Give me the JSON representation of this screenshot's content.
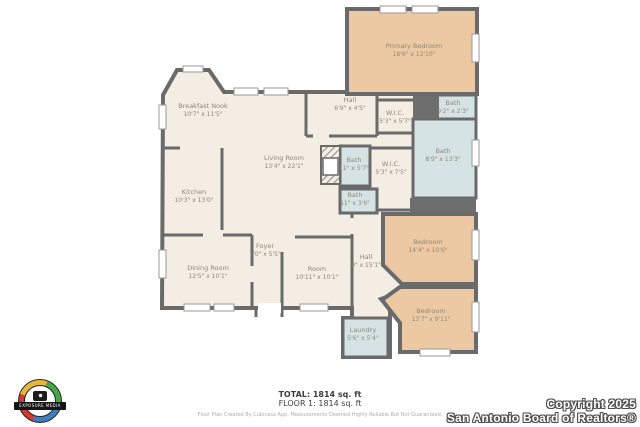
{
  "plan": {
    "rooms": [
      {
        "id": "primary-bedroom",
        "name": "Primary Bedroom",
        "dims": "18'6\" x 12'10\""
      },
      {
        "id": "breakfast-nook",
        "name": "Breakfast Nook",
        "dims": "10'7\" x 11'5\""
      },
      {
        "id": "living-room",
        "name": "Living Room",
        "dims": "13'4\" x 22'1\""
      },
      {
        "id": "kitchen",
        "name": "Kitchen",
        "dims": "10'3\" x 13'0\""
      },
      {
        "id": "dining-room",
        "name": "Dining Room",
        "dims": "12'5\" x 10'1\""
      },
      {
        "id": "foyer",
        "name": "Foyer",
        "dims": "7'0\" x 5'5\""
      },
      {
        "id": "room",
        "name": "Room",
        "dims": "10'11\" x 10'1\""
      },
      {
        "id": "hall-upper",
        "name": "Hall",
        "dims": "6'9\" x 4'5\""
      },
      {
        "id": "wic-upper",
        "name": "W.I.C.",
        "dims": "5'3\" x 5'7\""
      },
      {
        "id": "bath-niche",
        "name": "Bath",
        "dims": "9'2\" x 2'3\""
      },
      {
        "id": "bath-primary",
        "name": "Bath",
        "dims": "8'9\" x 13'3\""
      },
      {
        "id": "bath-hall",
        "name": "Bath",
        "dims": "11\" x 5'7\""
      },
      {
        "id": "wic-lower",
        "name": "W.I.C.",
        "dims": "5'3\" x 7'5\""
      },
      {
        "id": "bath-lower",
        "name": "Bath",
        "dims": "11\" x 3'6\""
      },
      {
        "id": "hall-lower",
        "name": "Hall",
        "dims": "9\" x 15'1\""
      },
      {
        "id": "bedroom-right",
        "name": "Bedroom",
        "dims": "14'4\" x 10'6\""
      },
      {
        "id": "bedroom-bottom",
        "name": "Bedroom",
        "dims": "13'7\" x 9'11\""
      },
      {
        "id": "laundry",
        "name": "Laundry",
        "dims": "5'6\" x 5'4\""
      }
    ],
    "colors": {
      "floor": "#f3ede3",
      "bedroom": "#ecc9a3",
      "wet_room": "#d5e3e4",
      "wall": "#6a6a6a"
    }
  },
  "footer": {
    "total": "TOTAL: 1814 sq. ft",
    "floor": "FLOOR 1: 1814 sq. ft",
    "disclaimer": "Floor Plan Created By Cubicasa App. Measurements Deemed Highly Reliable But Not Guaranteed."
  },
  "copyright": {
    "line1": "Copyright 2025",
    "line2": "San Antonio Board of Realtors®"
  },
  "logo": {
    "text": "EXPOSURE MEDIA"
  }
}
